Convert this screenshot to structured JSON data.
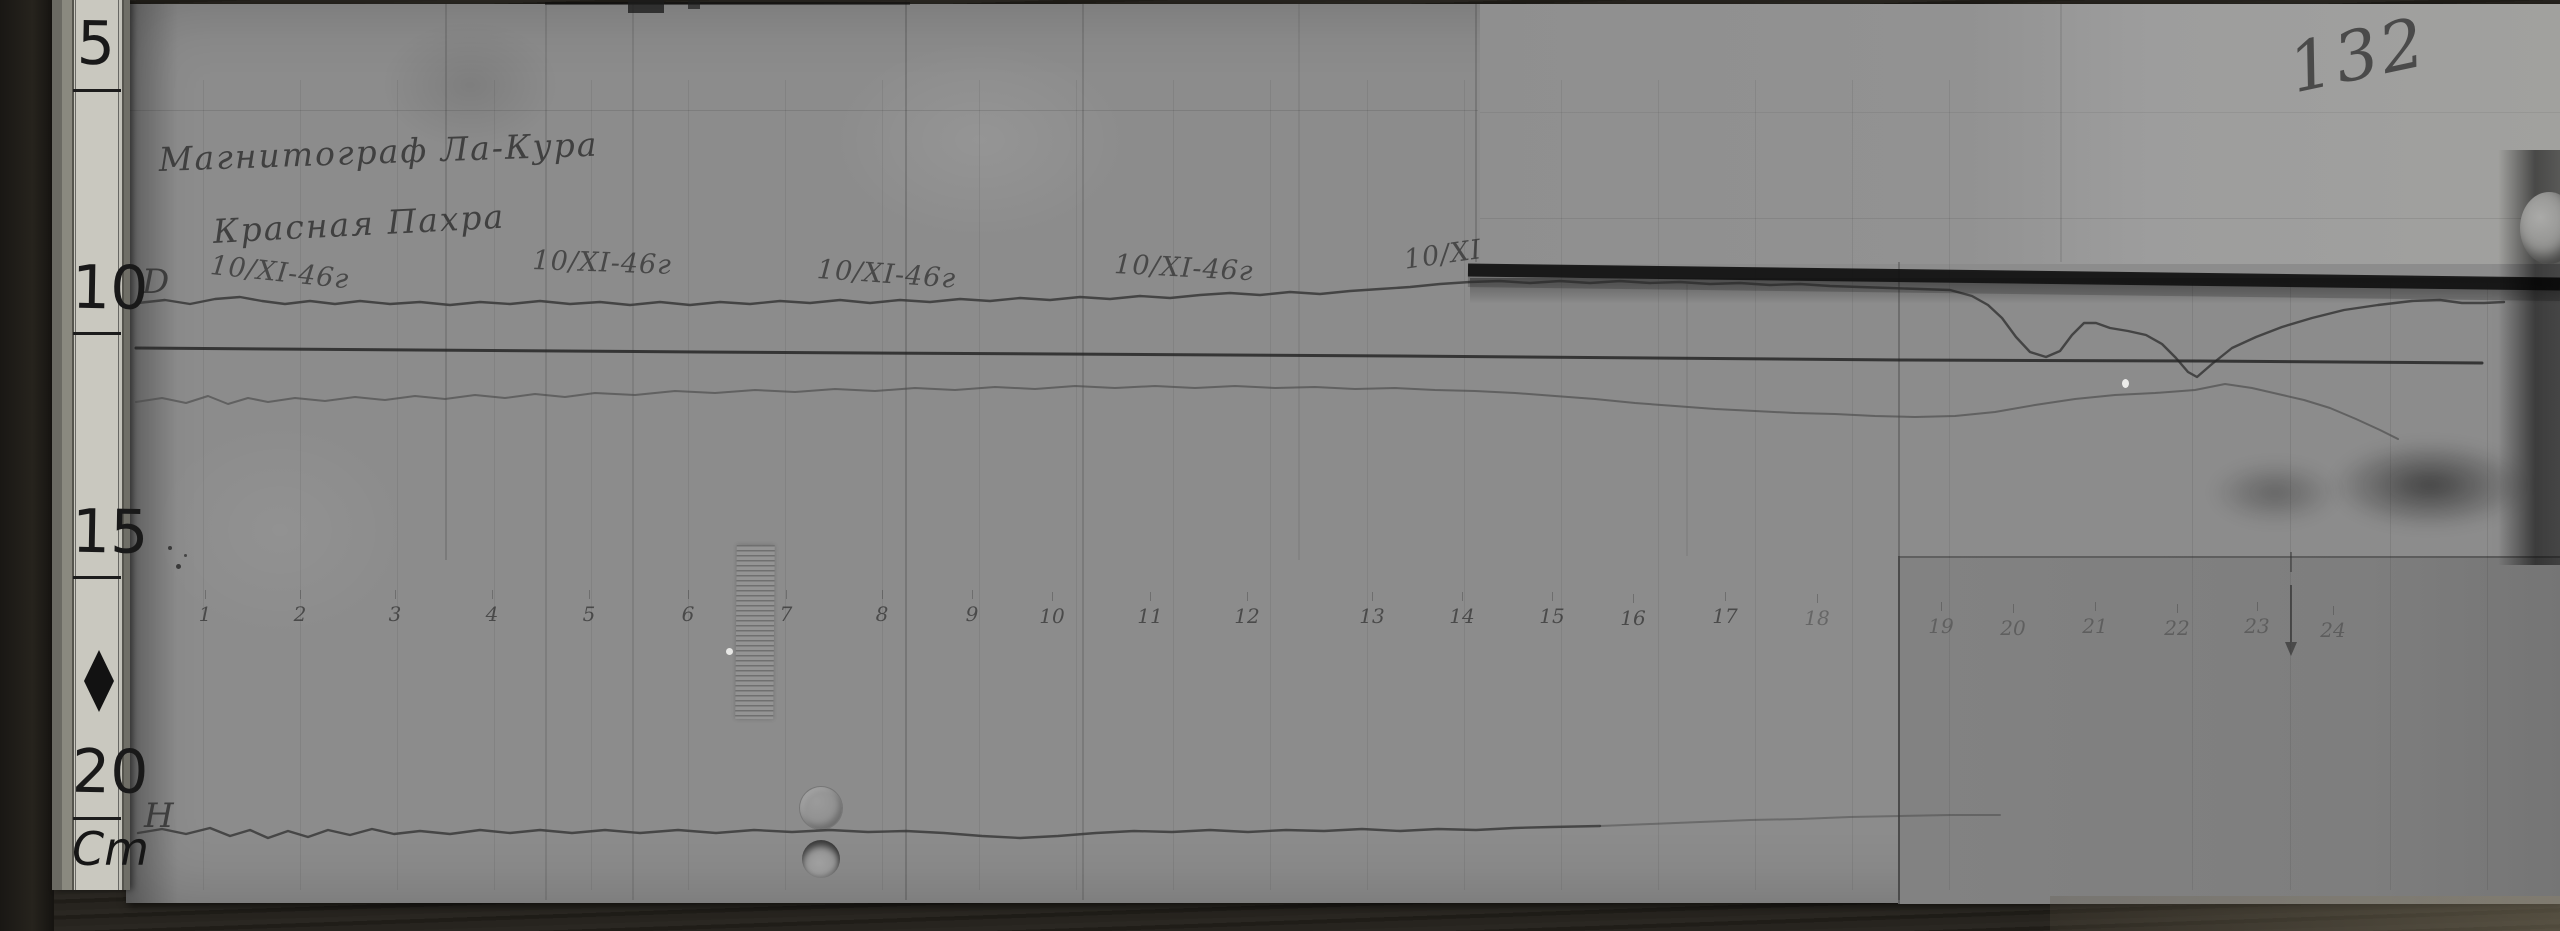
{
  "photo": {
    "page_number": "132",
    "title_line1": "Магнитограф Ла-Кура",
    "title_line2": "Красная Пахра"
  },
  "ruler": {
    "unit": "Cm",
    "unit_y": 822,
    "marks": [
      {
        "label": "5",
        "num_y": 14,
        "tick_y": 89
      },
      {
        "label": "10",
        "num_y": 258,
        "tick_y": 332
      },
      {
        "label": "15",
        "num_y": 502,
        "tick_y": 576
      },
      {
        "label": "20",
        "num_y": 742,
        "tick_y": 817
      }
    ]
  },
  "date_annotations": [
    {
      "text": "10/XI-46г",
      "x": 212,
      "y": 250,
      "rot": 6
    },
    {
      "text": "10/XI-46г",
      "x": 533,
      "y": 245,
      "rot": 2
    },
    {
      "text": "10/XI-46г",
      "x": 818,
      "y": 254,
      "rot": 4
    },
    {
      "text": "10/XI-46г",
      "x": 1115,
      "y": 249,
      "rot": 3
    },
    {
      "text": "10/XI",
      "x": 1402,
      "y": 245,
      "rot": -8
    }
  ],
  "trace_labels": [
    {
      "text": "D",
      "x": 142,
      "y": 262
    },
    {
      "text": "H",
      "x": 144,
      "y": 796
    }
  ],
  "axis_ticks": [
    {
      "label": "1",
      "x": 205,
      "y": 602,
      "faint": false
    },
    {
      "label": "2",
      "x": 300,
      "y": 602,
      "faint": false
    },
    {
      "label": "3",
      "x": 395,
      "y": 602,
      "faint": false
    },
    {
      "label": "4",
      "x": 492,
      "y": 602,
      "faint": false
    },
    {
      "label": "5",
      "x": 589,
      "y": 602,
      "faint": false
    },
    {
      "label": "6",
      "x": 688,
      "y": 602,
      "faint": false
    },
    {
      "label": "7",
      "x": 786,
      "y": 602,
      "faint": false
    },
    {
      "label": "8",
      "x": 882,
      "y": 602,
      "faint": false
    },
    {
      "label": "9",
      "x": 972,
      "y": 602,
      "faint": false
    },
    {
      "label": "10",
      "x": 1052,
      "y": 604,
      "faint": false
    },
    {
      "label": "11",
      "x": 1150,
      "y": 604,
      "faint": false
    },
    {
      "label": "12",
      "x": 1247,
      "y": 604,
      "faint": false
    },
    {
      "label": "13",
      "x": 1372,
      "y": 604,
      "faint": false
    },
    {
      "label": "14",
      "x": 1462,
      "y": 604,
      "faint": false
    },
    {
      "label": "15",
      "x": 1552,
      "y": 604,
      "faint": false
    },
    {
      "label": "16",
      "x": 1633,
      "y": 606,
      "faint": false
    },
    {
      "label": "17",
      "x": 1725,
      "y": 604,
      "faint": false
    },
    {
      "label": "18",
      "x": 1817,
      "y": 606,
      "faint": true
    },
    {
      "label": "19",
      "x": 1941,
      "y": 614,
      "faint": true
    },
    {
      "label": "20",
      "x": 2013,
      "y": 616,
      "faint": true
    },
    {
      "label": "21",
      "x": 2095,
      "y": 614,
      "faint": true
    },
    {
      "label": "22",
      "x": 2177,
      "y": 616,
      "faint": true
    },
    {
      "label": "23",
      "x": 2257,
      "y": 614,
      "faint": true
    },
    {
      "label": "24",
      "x": 2333,
      "y": 618,
      "faint": true
    }
  ],
  "arrow_marker": {
    "x": 2291,
    "dash_y1": 552,
    "dash_y2": 572,
    "shaft_y1": 585,
    "shaft_y2": 642,
    "head_y": 656
  },
  "traces": {
    "d": [
      [
        138,
        303
      ],
      [
        165,
        300
      ],
      [
        190,
        304
      ],
      [
        215,
        299
      ],
      [
        240,
        297
      ],
      [
        262,
        301
      ],
      [
        285,
        304
      ],
      [
        310,
        301
      ],
      [
        335,
        304
      ],
      [
        360,
        301
      ],
      [
        390,
        304
      ],
      [
        420,
        302
      ],
      [
        450,
        305
      ],
      [
        480,
        302
      ],
      [
        510,
        304
      ],
      [
        540,
        301
      ],
      [
        570,
        304
      ],
      [
        600,
        302
      ],
      [
        630,
        305
      ],
      [
        660,
        302
      ],
      [
        690,
        305
      ],
      [
        720,
        302
      ],
      [
        750,
        304
      ],
      [
        780,
        301
      ],
      [
        810,
        303
      ],
      [
        840,
        300
      ],
      [
        870,
        303
      ],
      [
        900,
        300
      ],
      [
        930,
        302
      ],
      [
        960,
        299
      ],
      [
        990,
        301
      ],
      [
        1020,
        298
      ],
      [
        1050,
        300
      ],
      [
        1080,
        297
      ],
      [
        1110,
        299
      ],
      [
        1140,
        296
      ],
      [
        1170,
        298
      ],
      [
        1200,
        295
      ],
      [
        1230,
        293
      ],
      [
        1260,
        295
      ],
      [
        1290,
        292
      ],
      [
        1320,
        294
      ],
      [
        1350,
        291
      ],
      [
        1380,
        289
      ],
      [
        1410,
        287
      ],
      [
        1440,
        284
      ],
      [
        1470,
        282
      ],
      [
        1500,
        281
      ],
      [
        1530,
        283
      ],
      [
        1560,
        281
      ],
      [
        1590,
        283
      ],
      [
        1620,
        281
      ],
      [
        1650,
        283
      ],
      [
        1680,
        282
      ],
      [
        1710,
        284
      ],
      [
        1740,
        283
      ],
      [
        1770,
        285
      ],
      [
        1800,
        284
      ],
      [
        1830,
        286
      ],
      [
        1860,
        287
      ],
      [
        1890,
        288
      ],
      [
        1920,
        289
      ],
      [
        1950,
        290
      ],
      [
        1972,
        296
      ],
      [
        1988,
        305
      ],
      [
        2002,
        318
      ],
      [
        2016,
        337
      ],
      [
        2030,
        352
      ],
      [
        2046,
        357
      ],
      [
        2060,
        351
      ],
      [
        2072,
        335
      ],
      [
        2084,
        323
      ],
      [
        2096,
        323
      ],
      [
        2110,
        328
      ],
      [
        2128,
        331
      ],
      [
        2146,
        335
      ],
      [
        2162,
        344
      ],
      [
        2176,
        358
      ],
      [
        2188,
        372
      ],
      [
        2197,
        377
      ],
      [
        2212,
        364
      ],
      [
        2232,
        348
      ],
      [
        2256,
        337
      ],
      [
        2282,
        327
      ],
      [
        2312,
        318
      ],
      [
        2344,
        310
      ],
      [
        2378,
        305
      ],
      [
        2412,
        301
      ],
      [
        2440,
        300
      ],
      [
        2462,
        303
      ],
      [
        2484,
        303
      ],
      [
        2504,
        302
      ]
    ],
    "baseline": [
      [
        136,
        348
      ],
      [
        700,
        352
      ],
      [
        1400,
        356
      ],
      [
        1900,
        360
      ],
      [
        2200,
        361
      ],
      [
        2482,
        363
      ]
    ],
    "hmid": [
      [
        136,
        402
      ],
      [
        162,
        398
      ],
      [
        186,
        403
      ],
      [
        208,
        396
      ],
      [
        228,
        404
      ],
      [
        248,
        398
      ],
      [
        268,
        402
      ],
      [
        295,
        398
      ],
      [
        325,
        401
      ],
      [
        355,
        397
      ],
      [
        385,
        400
      ],
      [
        415,
        396
      ],
      [
        445,
        399
      ],
      [
        475,
        395
      ],
      [
        505,
        398
      ],
      [
        535,
        394
      ],
      [
        565,
        397
      ],
      [
        595,
        393
      ],
      [
        635,
        395
      ],
      [
        675,
        391
      ],
      [
        715,
        393
      ],
      [
        755,
        390
      ],
      [
        795,
        392
      ],
      [
        835,
        389
      ],
      [
        875,
        391
      ],
      [
        915,
        388
      ],
      [
        955,
        390
      ],
      [
        995,
        387
      ],
      [
        1035,
        389
      ],
      [
        1075,
        386
      ],
      [
        1115,
        388
      ],
      [
        1155,
        386
      ],
      [
        1195,
        388
      ],
      [
        1235,
        386
      ],
      [
        1275,
        388
      ],
      [
        1315,
        387
      ],
      [
        1355,
        389
      ],
      [
        1395,
        388
      ],
      [
        1435,
        390
      ],
      [
        1475,
        391
      ],
      [
        1515,
        393
      ],
      [
        1555,
        396
      ],
      [
        1595,
        399
      ],
      [
        1635,
        403
      ],
      [
        1675,
        406
      ],
      [
        1715,
        409
      ],
      [
        1755,
        411
      ],
      [
        1795,
        413
      ],
      [
        1835,
        414
      ],
      [
        1875,
        416
      ],
      [
        1915,
        417
      ],
      [
        1955,
        416
      ],
      [
        1995,
        412
      ],
      [
        2035,
        405
      ],
      [
        2075,
        399
      ],
      [
        2115,
        395
      ],
      [
        2155,
        393
      ],
      [
        2195,
        390
      ],
      [
        2225,
        384
      ],
      [
        2252,
        388
      ],
      [
        2278,
        394
      ],
      [
        2304,
        400
      ],
      [
        2330,
        408
      ],
      [
        2356,
        419
      ],
      [
        2380,
        430
      ],
      [
        2398,
        439
      ]
    ],
    "bottom": [
      [
        138,
        833
      ],
      [
        162,
        829
      ],
      [
        186,
        834
      ],
      [
        210,
        828
      ],
      [
        230,
        836
      ],
      [
        250,
        830
      ],
      [
        268,
        838
      ],
      [
        288,
        831
      ],
      [
        308,
        837
      ],
      [
        328,
        830
      ],
      [
        350,
        835
      ],
      [
        372,
        829
      ],
      [
        394,
        834
      ],
      [
        420,
        831
      ],
      [
        450,
        834
      ],
      [
        480,
        830
      ],
      [
        510,
        833
      ],
      [
        540,
        830
      ],
      [
        572,
        833
      ],
      [
        605,
        830
      ],
      [
        640,
        833
      ],
      [
        678,
        830
      ],
      [
        716,
        833
      ],
      [
        754,
        830
      ],
      [
        792,
        832
      ],
      [
        830,
        830
      ],
      [
        868,
        832
      ],
      [
        906,
        831
      ],
      [
        944,
        833
      ],
      [
        982,
        836
      ],
      [
        1020,
        838
      ],
      [
        1058,
        836
      ],
      [
        1096,
        833
      ],
      [
        1134,
        831
      ],
      [
        1172,
        832
      ],
      [
        1210,
        830
      ],
      [
        1248,
        832
      ],
      [
        1286,
        830
      ],
      [
        1324,
        831
      ],
      [
        1362,
        829
      ],
      [
        1400,
        831
      ],
      [
        1438,
        829
      ],
      [
        1476,
        830
      ],
      [
        1514,
        828
      ],
      [
        1552,
        827
      ],
      [
        1600,
        826
      ]
    ],
    "bottom_faint": [
      [
        1600,
        826
      ],
      [
        1650,
        824
      ],
      [
        1700,
        822
      ],
      [
        1750,
        820
      ],
      [
        1800,
        819
      ],
      [
        1850,
        817
      ],
      [
        1900,
        816
      ],
      [
        1950,
        815
      ],
      [
        2000,
        815
      ]
    ]
  },
  "colors": {
    "paper": "#8c8c8c",
    "paper_light": "#a1a19e",
    "paper_dark": "#7e7e7e",
    "ruler_face": "#c9c8bf",
    "ink": "#2e2e2e",
    "shadow_band": "#121212",
    "wood": "#23201b"
  }
}
